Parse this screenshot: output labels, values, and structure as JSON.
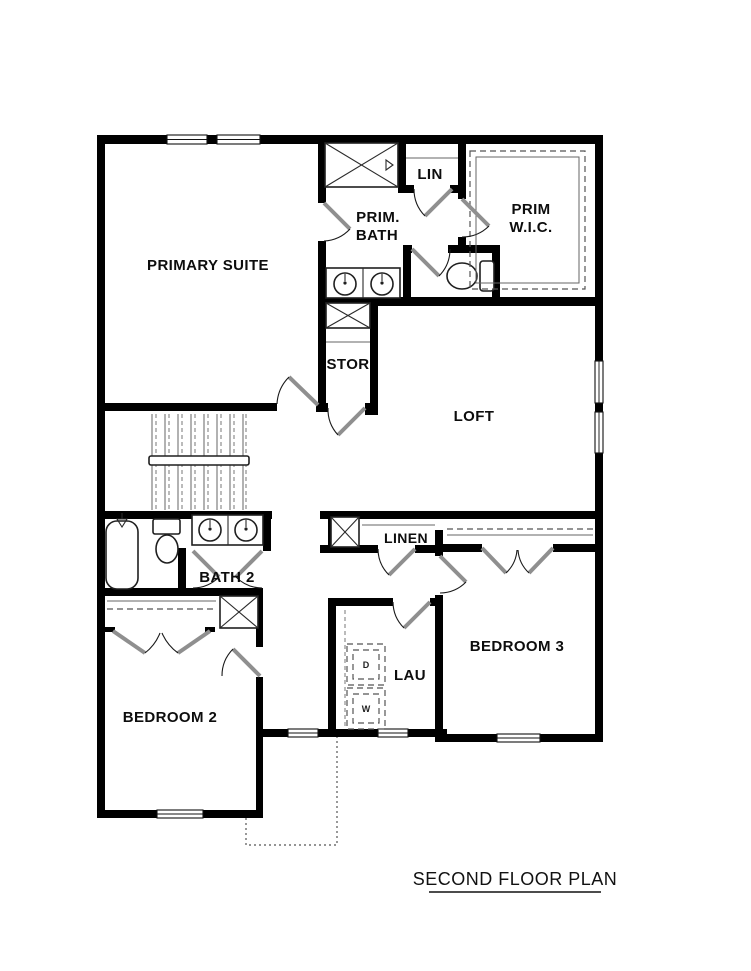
{
  "title": {
    "text": "SECOND FLOOR PLAN"
  },
  "rooms": {
    "primary_suite": "PRIMARY SUITE",
    "prim_bath_line1": "PRIM.",
    "prim_bath_line2": "BATH",
    "lin": "LIN",
    "prim_wic_line1": "PRIM",
    "prim_wic_line2": "W.I.C.",
    "stor": "STOR",
    "loft": "LOFT",
    "bath2": "BATH 2",
    "linen": "LINEN",
    "bedroom2": "BEDROOM 2",
    "bedroom3": "BEDROOM 3",
    "lau": "LAU",
    "dryer": "D",
    "washer": "W"
  },
  "colors": {
    "wall": "#000000",
    "door_leaf": "#8f8f8f",
    "fixture_stroke": "#1f1f1f",
    "dashed_line": "#555555",
    "background": "#ffffff"
  }
}
